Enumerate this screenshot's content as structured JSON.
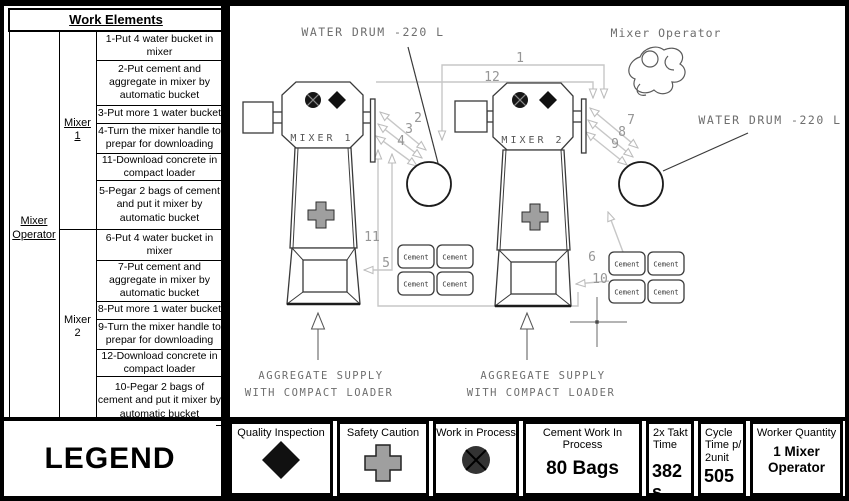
{
  "table": {
    "header": "Work Elements",
    "operator": "Mixer Operator",
    "groups": [
      {
        "label": "Mixer 1",
        "steps": [
          "1-Put 4 water bucket in mixer",
          "2-Put cement and aggregate in mixer by automatic bucket",
          "3-Put more 1 water bucket",
          "4-Turn the mixer handle to prepar for downloading",
          "11-Download concrete in compact loader",
          "5-Pegar 2 bags of cement and put it mixer by automatic bucket"
        ]
      },
      {
        "label": "Mixer 2",
        "steps": [
          "6-Put 4 water bucket in mixer",
          "7-Put cement and aggregate in mixer by automatic bucket",
          "8-Put more 1 water bucket",
          "9-Turn the mixer handle to prepar for downloading",
          "12-Download concrete in compact loader",
          "10-Pegar 2 bags of cement and put it mixer by automatic bucket"
        ]
      }
    ]
  },
  "diagram": {
    "mixer1": "MIXER 1",
    "mixer2": "MIXER 2",
    "water_drum_top": "WATER DRUM -220 L",
    "water_drum_right": "WATER DRUM -220 L",
    "operator": "Mixer Operator",
    "cement": "Cement",
    "aggregate1": "AGGREGATE SUPPLY",
    "aggregate2": "WITH COMPACT LOADER",
    "flow": {
      "f1": "1",
      "f2": "2",
      "f3": "3",
      "f4": "4",
      "f5": "5",
      "f6": "6",
      "f7": "7",
      "f8": "8",
      "f9": "9",
      "f10": "10",
      "f11": "11",
      "f12": "12"
    }
  },
  "legend": {
    "title": "LEGEND",
    "quality": "Quality Inspection",
    "safety": "Safety Caution",
    "wip": "Work in Process",
    "cement_wip_label": "Cement Work In Process",
    "cement_wip_value": "80 Bags",
    "takt_label": "2x Takt Time",
    "takt_value": "382 s",
    "cycle_label": "Cycle Time p/ 2unit",
    "cycle_value": "505 s",
    "worker_label": "Worker Quantity",
    "worker_value": "1 Mixer Operator"
  },
  "colors": {
    "frame": "#000000",
    "safety_cross": "#9f9f9f",
    "wip_circle": "#333333",
    "quality_diamond": "#111111",
    "cad_line": "#c7c7c7"
  }
}
